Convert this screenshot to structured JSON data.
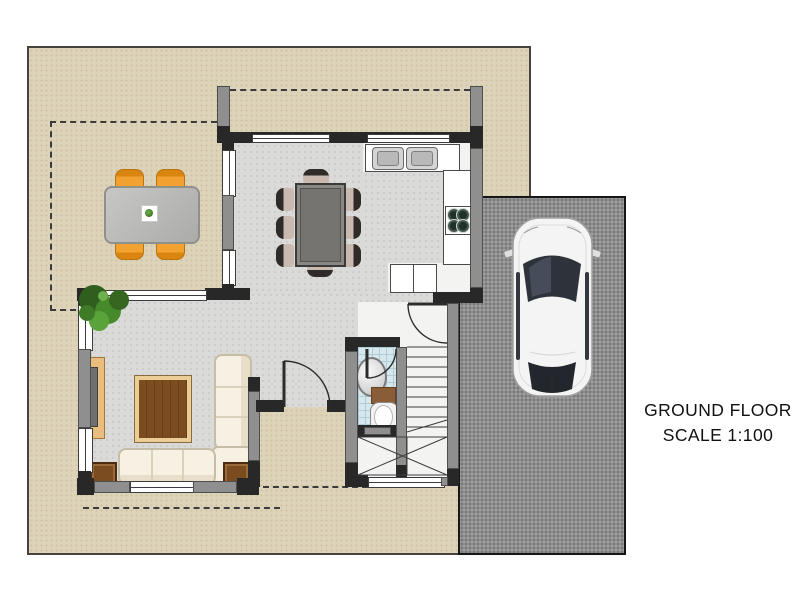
{
  "annotation": {
    "line1": "GROUND FLOOR",
    "line2": "SCALE 1:100"
  },
  "colors": {
    "patio": "#ddd3ba",
    "driveway": "#8d8d8d",
    "wall-dark": "#282828",
    "wall-gray": "#8f8f8f",
    "floor": "#dadad9",
    "bath-floor": "#d6e8ee",
    "chair-orange": "#f2a231",
    "wood": "#7a4c1f",
    "sofa-cream": "#f6f1e3",
    "car-white": "#f4f4f4",
    "plant-green": "#478a2b",
    "text": "#111111"
  },
  "objects": [
    {
      "name": "patio-terrace",
      "count": 1
    },
    {
      "name": "driveway",
      "count": 1
    },
    {
      "name": "car-top-view",
      "count": 1
    },
    {
      "name": "outdoor-dining-table",
      "count": 1
    },
    {
      "name": "outdoor-chair",
      "count": 4
    },
    {
      "name": "dining-table",
      "count": 1
    },
    {
      "name": "dining-chair",
      "count": 8
    },
    {
      "name": "kitchen-counter",
      "count": 2
    },
    {
      "name": "double-sink",
      "count": 1
    },
    {
      "name": "stove-four-burner",
      "count": 1
    },
    {
      "name": "kitchen-cabinet",
      "count": 1
    },
    {
      "name": "l-shaped-sofa",
      "count": 1
    },
    {
      "name": "coffee-table",
      "count": 1
    },
    {
      "name": "tv-console",
      "count": 1
    },
    {
      "name": "side-table",
      "count": 2
    },
    {
      "name": "potted-plant",
      "count": 1
    },
    {
      "name": "bathroom-basin",
      "count": 1
    },
    {
      "name": "toilet",
      "count": 1
    },
    {
      "name": "bath-mat",
      "count": 1
    },
    {
      "name": "staircase",
      "count": 1
    },
    {
      "name": "door-swing",
      "count": 3
    },
    {
      "name": "window",
      "count": 8
    },
    {
      "name": "upper-floor-dashed-outline",
      "count": 1
    }
  ]
}
